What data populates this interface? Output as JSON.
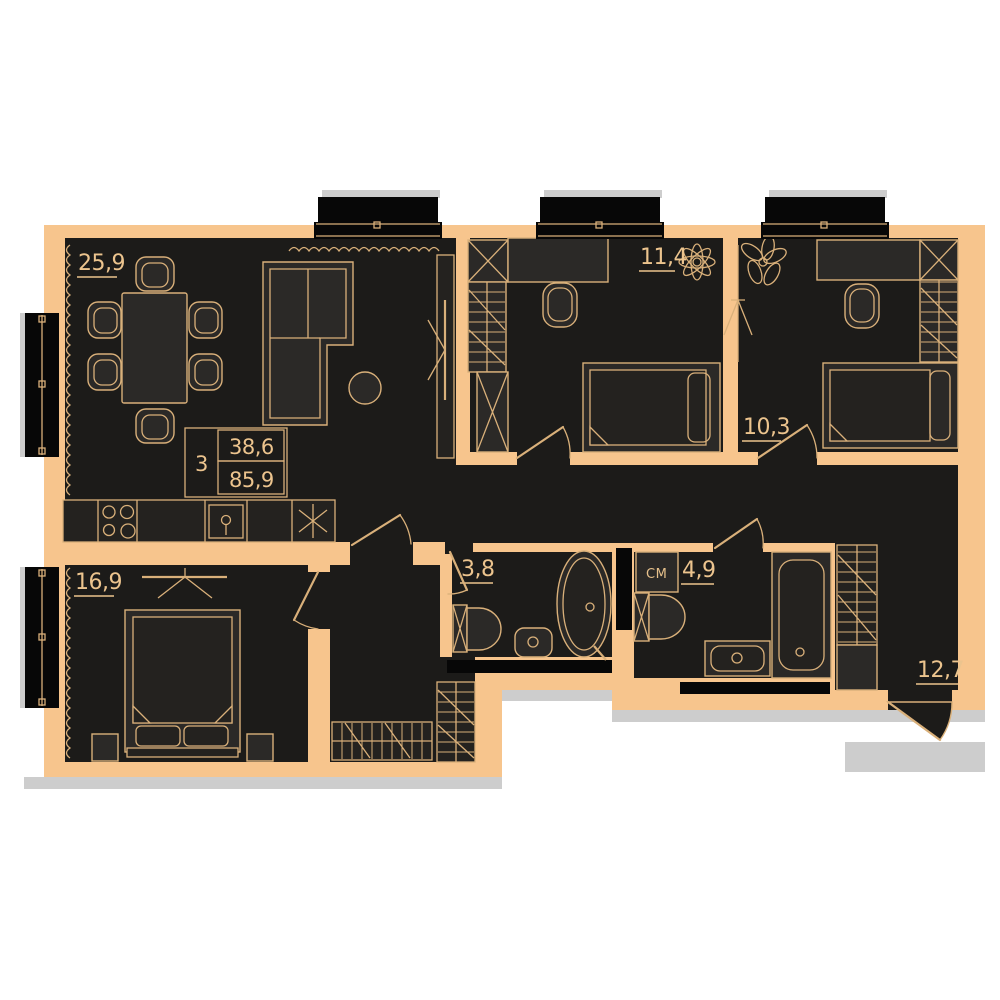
{
  "floorplan": {
    "summary": {
      "rooms_label": "3",
      "value_top": "38,6",
      "value_bottom": "85,9"
    },
    "rooms": [
      {
        "id": "living-kitchen",
        "area": "25,9"
      },
      {
        "id": "bedroom-top-middle",
        "area": "11,4"
      },
      {
        "id": "bedroom-top-right",
        "area": "10,3"
      },
      {
        "id": "bedroom-bottom-left",
        "area": "16,9"
      },
      {
        "id": "bathroom-small",
        "area": "3,8"
      },
      {
        "id": "bathroom-large",
        "area": "4,9"
      },
      {
        "id": "hallway",
        "area": "12,7"
      }
    ],
    "appliance_labels": {
      "washing_machine": "СМ"
    },
    "colors": {
      "wall": "#f7c58d",
      "room_fill": "#1c1b19",
      "furniture_fill": "#2b2927",
      "line": "#d9b07a",
      "window_black": "#070707",
      "shadow": "#cdcdcd",
      "label_text": "#ecc48e",
      "background": "#ffffff"
    }
  }
}
